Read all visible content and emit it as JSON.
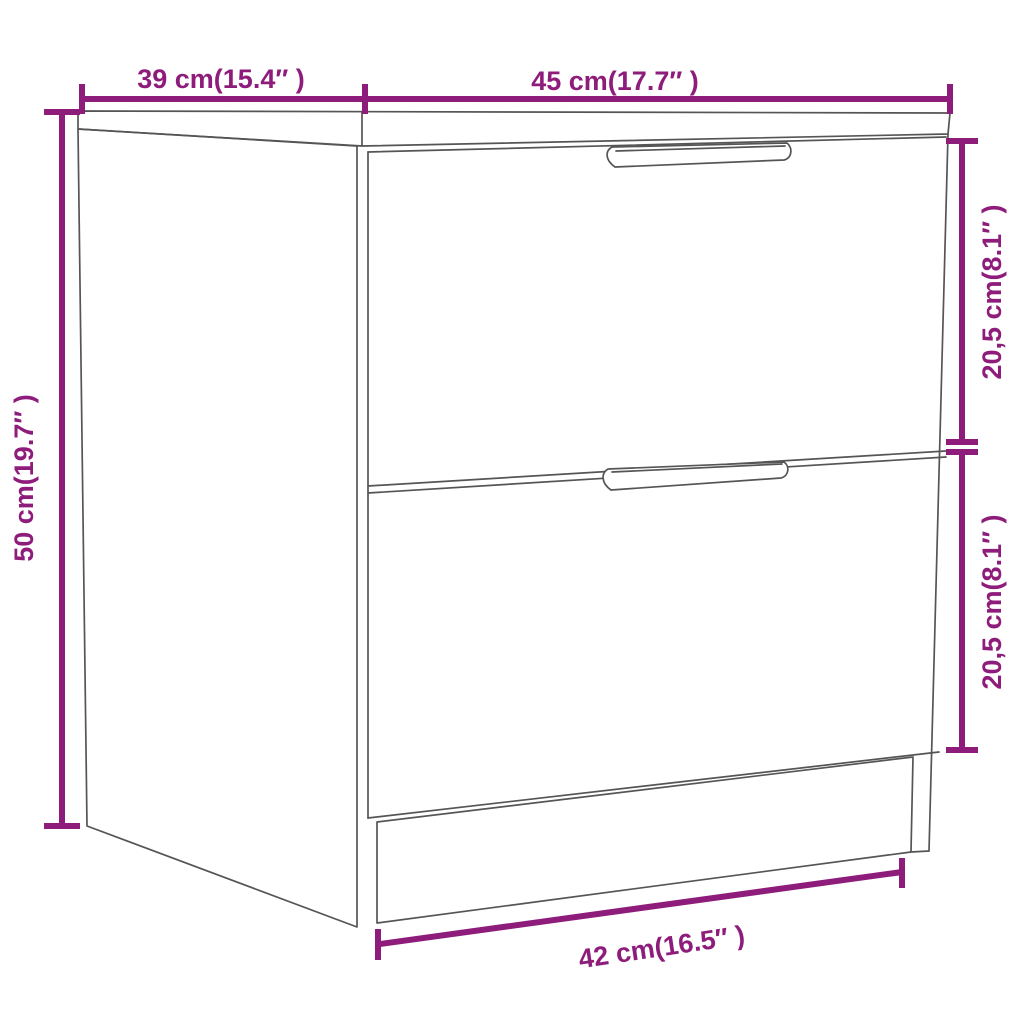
{
  "page": {
    "background_color": "#ffffff"
  },
  "diagram": {
    "accent_color": "#8E1C7B",
    "line_color": "#555555",
    "dimensions": {
      "top_depth": {
        "label": "39 cm(15.4″ )",
        "cm": "39",
        "inches": "15.4"
      },
      "top_width": {
        "label": "45 cm(17.7″ )",
        "cm": "45",
        "inches": "17.7"
      },
      "height": {
        "label": "50 cm(19.7″ )",
        "cm": "50",
        "inches": "19.7"
      },
      "upper_drawer": {
        "label": "20,5 cm(8.1″ )",
        "cm": "20,5",
        "inches": "8.1"
      },
      "lower_drawer": {
        "label": "20,5 cm(8.1″ )",
        "cm": "20,5",
        "inches": "8.1"
      },
      "base_width": {
        "label": "42 cm(16.5″ )",
        "cm": "42",
        "inches": "16.5"
      }
    }
  }
}
